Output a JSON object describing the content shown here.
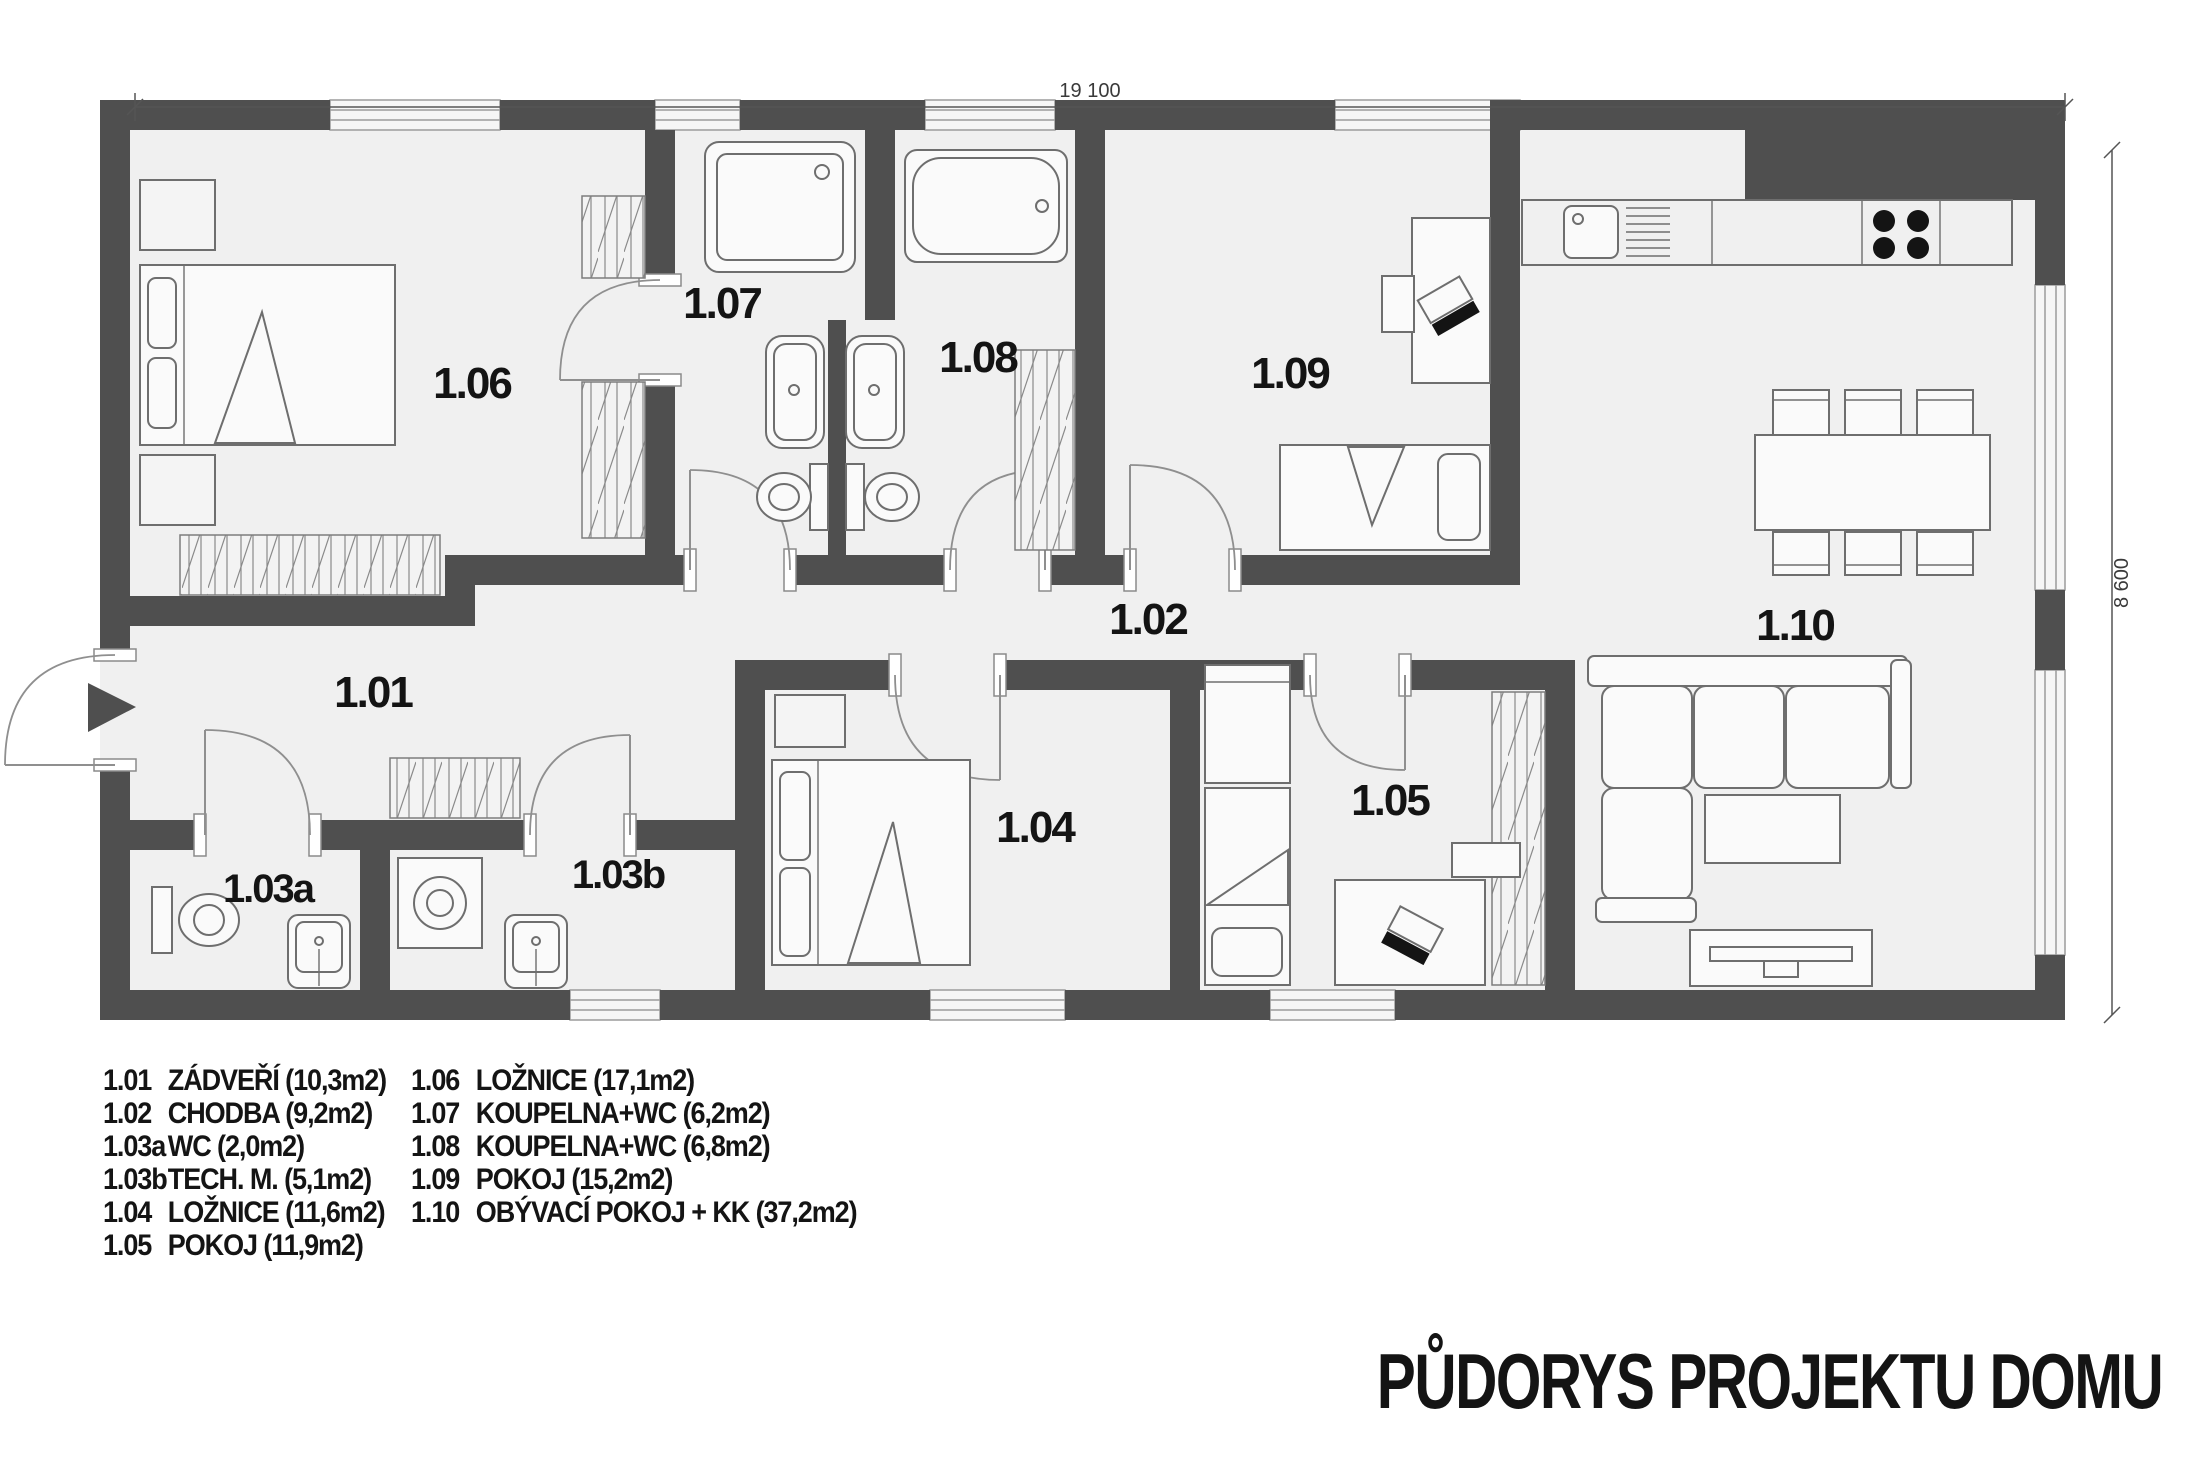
{
  "title": "PŮDORYS PROJEKTU DOMU",
  "dimensions": {
    "width": "19 100",
    "height": "8 600"
  },
  "rooms": [
    {
      "code": "1.01",
      "legend": "ZÁDVEŘÍ (10,3m2)"
    },
    {
      "code": "1.02",
      "legend": "CHODBA (9,2m2)"
    },
    {
      "code": "1.03a",
      "legend": "WC (2,0m2)"
    },
    {
      "code": "1.03b",
      "legend": "TECH. M. (5,1m2)"
    },
    {
      "code": "1.04",
      "legend": "LOŽNICE (11,6m2)"
    },
    {
      "code": "1.05",
      "legend": "POKOJ (11,9m2)"
    },
    {
      "code": "1.06",
      "legend": "LOŽNICE (17,1m2)"
    },
    {
      "code": "1.07",
      "legend": "KOUPELNA+WC (6,2m2)"
    },
    {
      "code": "1.08",
      "legend": "KOUPELNA+WC (6,8m2)"
    },
    {
      "code": "1.09",
      "legend": "POKOJ (15,2m2)"
    },
    {
      "code": "1.10",
      "legend": "OBÝVACÍ POKOJ + KK (37,2m2)"
    }
  ],
  "colors": {
    "wall": "#4f4f4f",
    "floor": "#f0f0f0",
    "text": "#141414",
    "line": "#6e6e6e"
  }
}
